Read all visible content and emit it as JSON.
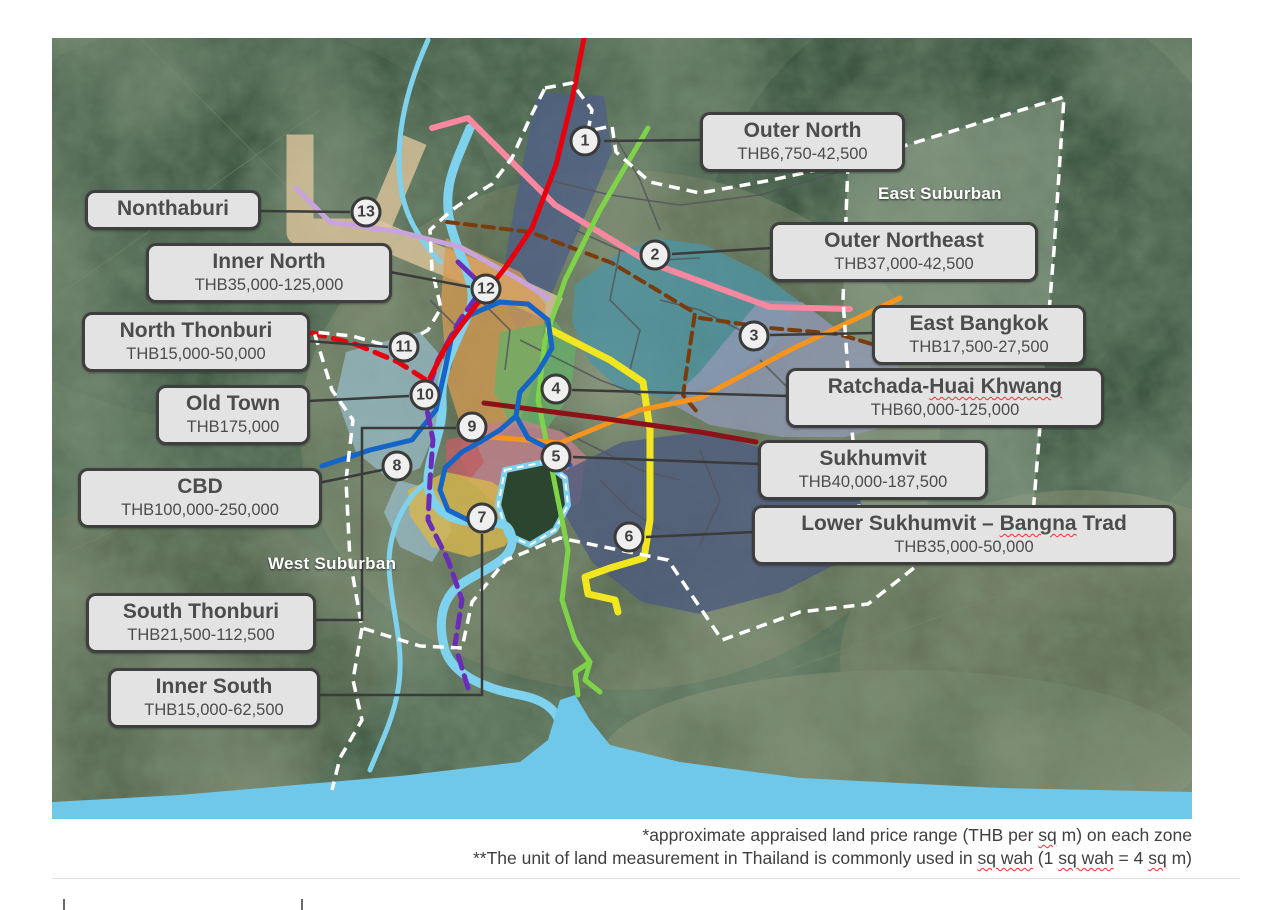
{
  "map": {
    "region_labels": [
      {
        "text": "East Suburban",
        "x": 878,
        "y": 184
      },
      {
        "text": "West Suburban",
        "x": 268,
        "y": 554
      }
    ],
    "markers": [
      {
        "num": "1",
        "x": 585,
        "y": 141
      },
      {
        "num": "2",
        "x": 655,
        "y": 255
      },
      {
        "num": "3",
        "x": 754,
        "y": 336
      },
      {
        "num": "4",
        "x": 556,
        "y": 389
      },
      {
        "num": "5",
        "x": 556,
        "y": 457
      },
      {
        "num": "6",
        "x": 629,
        "y": 537
      },
      {
        "num": "7",
        "x": 482,
        "y": 518
      },
      {
        "num": "8",
        "x": 397,
        "y": 466
      },
      {
        "num": "9",
        "x": 472,
        "y": 427
      },
      {
        "num": "10",
        "x": 425,
        "y": 395
      },
      {
        "num": "11",
        "x": 404,
        "y": 347
      },
      {
        "num": "12",
        "x": 486,
        "y": 289
      },
      {
        "num": "13",
        "x": 366,
        "y": 212
      }
    ],
    "zone_labels": [
      {
        "id": "outer-north",
        "title": [
          {
            "t": "Outer North"
          }
        ],
        "price": "THB6,750-42,500",
        "x": 700,
        "y": 112,
        "w": 205
      },
      {
        "id": "outer-northeast",
        "title": [
          {
            "t": "Outer Northeast"
          }
        ],
        "price": "THB37,000-42,500",
        "x": 770,
        "y": 222,
        "w": 268
      },
      {
        "id": "east-bangkok",
        "title": [
          {
            "t": "East Bangkok"
          }
        ],
        "price": "THB17,500-27,500",
        "x": 872,
        "y": 305,
        "w": 214
      },
      {
        "id": "ratchada-huai-khwang",
        "title": [
          {
            "t": "Ratchada-"
          },
          {
            "t": "Huai Khwang",
            "sq": true
          }
        ],
        "price": "THB60,000-125,000",
        "x": 786,
        "y": 368,
        "w": 318
      },
      {
        "id": "sukhumvit",
        "title": [
          {
            "t": "Sukhumvit"
          }
        ],
        "price": "THB40,000-187,500",
        "x": 758,
        "y": 440,
        "w": 230
      },
      {
        "id": "lower-sukhumvit-bangna-trad",
        "title": [
          {
            "t": "Lower Sukhumvit – "
          },
          {
            "t": "Bangna",
            "sq": true
          },
          {
            "t": " Trad"
          }
        ],
        "price": "THB35,000-50,000",
        "x": 752,
        "y": 505,
        "w": 424
      },
      {
        "id": "nonthaburi",
        "title": [
          {
            "t": "Nonthaburi"
          }
        ],
        "price": null,
        "x": 85,
        "y": 190,
        "w": 176
      },
      {
        "id": "inner-north",
        "title": [
          {
            "t": "Inner North"
          }
        ],
        "price": "THB35,000-125,000",
        "x": 146,
        "y": 243,
        "w": 246
      },
      {
        "id": "north-thonburi",
        "title": [
          {
            "t": "North Thonburi"
          }
        ],
        "price": "THB15,000-50,000",
        "x": 82,
        "y": 312,
        "w": 228
      },
      {
        "id": "old-town",
        "title": [
          {
            "t": "Old Town"
          }
        ],
        "price": "THB175,000",
        "x": 156,
        "y": 385,
        "w": 154
      },
      {
        "id": "cbd",
        "title": [
          {
            "t": "CBD"
          }
        ],
        "price": "THB100,000-250,000",
        "x": 78,
        "y": 468,
        "w": 244
      },
      {
        "id": "south-thonburi",
        "title": [
          {
            "t": "South Thonburi"
          }
        ],
        "price": "THB21,500-112,500",
        "x": 86,
        "y": 593,
        "w": 230
      },
      {
        "id": "inner-south",
        "title": [
          {
            "t": "Inner South"
          }
        ],
        "price": "THB15,000-62,500",
        "x": 108,
        "y": 668,
        "w": 212
      }
    ]
  },
  "footnotes": [
    {
      "segments": [
        {
          "t": "*approximate appraised land price range (THB per "
        },
        {
          "t": "sq",
          "sq": true
        },
        {
          "t": " m) on each zone"
        }
      ]
    },
    {
      "segments": [
        {
          "t": "**The unit of land measurement in Thailand is commonly used in "
        },
        {
          "t": "sq wah",
          "sq": true
        },
        {
          "t": " (1 "
        },
        {
          "t": "sq wah",
          "sq": true
        },
        {
          "t": " = 4 "
        },
        {
          "t": "sq",
          "sq": true
        },
        {
          "t": " m)"
        }
      ]
    }
  ],
  "colors": {
    "route-red": "#e8000d",
    "route-pink": "#f8879f",
    "route-green": "#7ed348",
    "route-yellow": "#f2e71f",
    "route-orange": "#f7941d",
    "route-maroon": "#8c1218",
    "route-blue": "#1565c8",
    "route-cyan": "#7fd2ee",
    "route-purple": "#6a2db8",
    "route-lavender": "#c9a3dc",
    "route-brown": "#7a3c0d",
    "zone-outer-north": "#4f5f86",
    "zone-outer-northeast": "#4f93a3",
    "zone-east-bangkok": "#9099b3",
    "zone-east-suburban": "#93a690",
    "zone-inner-north": "#d79b52",
    "zone-ratchada": "#66b06a",
    "zone-thonburi": "#9cc3d6",
    "zone-sukhumvit": "#c2808c",
    "zone-cbd": "#bf5f63",
    "zone-old-town": "#d8b64e",
    "zone-lower-sukhumvit": "#4d5b7e",
    "zone-nonthaburi": "#dcc49c",
    "water": "#6fc8ea",
    "label-bg": "#e3e3e3",
    "label-border": "#3f3f3f",
    "label-text": "#4c4c4c",
    "squiggle": "#ff2a2a"
  }
}
